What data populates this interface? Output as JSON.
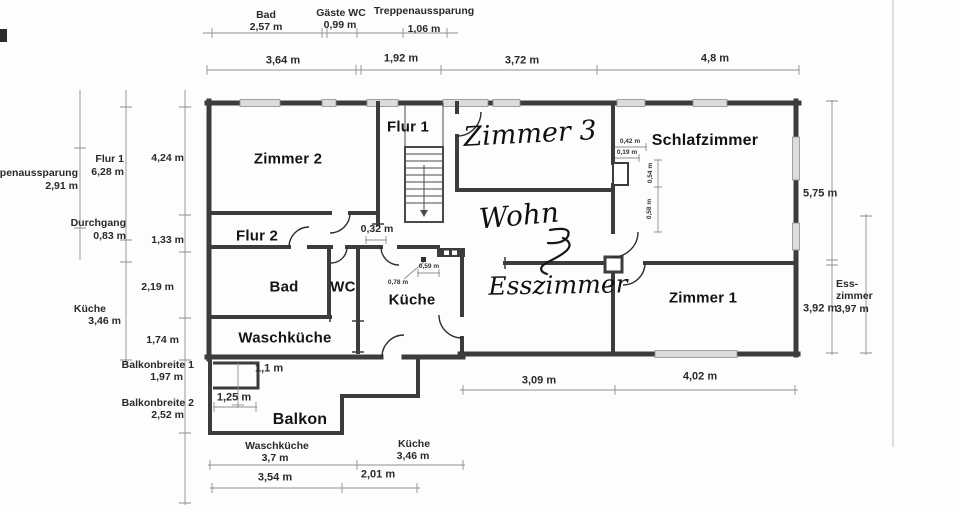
{
  "rooms": {
    "zimmer2": "Zimmer 2",
    "flur1": "Flur 1",
    "zimmer3": "Zimmer 3",
    "schlafzimmer": "Schlafzimmer",
    "flur2": "Flur 2",
    "bad": "Bad",
    "wc": "WC",
    "kueche": "Küche",
    "wohn": "Wohn",
    "esszimmer": "Esszimmer",
    "zimmer1": "Zimmer 1",
    "waschkueche": "Waschküche",
    "balkon": "Balkon"
  },
  "top_dims": {
    "bad_label": "Bad",
    "bad_value": "2,57 m",
    "gaeste_wc_label": "Gäste WC",
    "gaeste_wc_value": "0,99 m",
    "treppe_label": "Treppenaussparung",
    "treppe_value": "1,06 m",
    "w1": "3,64 m",
    "w2": "1,92 m",
    "w3": "3,72 m",
    "w4": "4,8 m"
  },
  "left_dims": {
    "treppe_label": "ppenaussparung",
    "treppe_value": "2,91 m",
    "flur1_label": "Flur 1",
    "flur1_value": "6,28 m",
    "v424": "4,24 m",
    "durchgang_label": "Durchgang",
    "durchgang_value": "0,83 m",
    "v133": "1,33 m",
    "v219": "2,19 m",
    "kueche_label": "Küche",
    "kueche_value": "3,46 m",
    "v174": "1,74 m",
    "balkon1_label": "Balkonbreite 1",
    "balkon1_value": "1,97 m",
    "balkon2_label": "Balkonbreite 2",
    "balkon2_value": "2,52 m"
  },
  "right_dims": {
    "v575": "5,75 m",
    "v392": "3,92 m",
    "essz_line1": "Ess-",
    "essz_line2": "zimmer",
    "essz_value": "3,97 m"
  },
  "bottom_dims": {
    "v309": "3,09 m",
    "v402": "4,02 m",
    "v11": "1,1 m",
    "v125": "1,25 m",
    "wasch_label": "Waschküche",
    "wasch_value": "3,7 m",
    "kueche_label": "Küche",
    "kueche_value": "3,46 m",
    "v354": "3,54 m",
    "v201": "2,01 m"
  },
  "inner_dims": {
    "v032": "0,32 m",
    "v042": "0,42 m",
    "v019": "0,19 m",
    "v054": "0,54 m",
    "v058": "0,58 m",
    "v059": "0,59 m",
    "v078": "0,78 m"
  }
}
